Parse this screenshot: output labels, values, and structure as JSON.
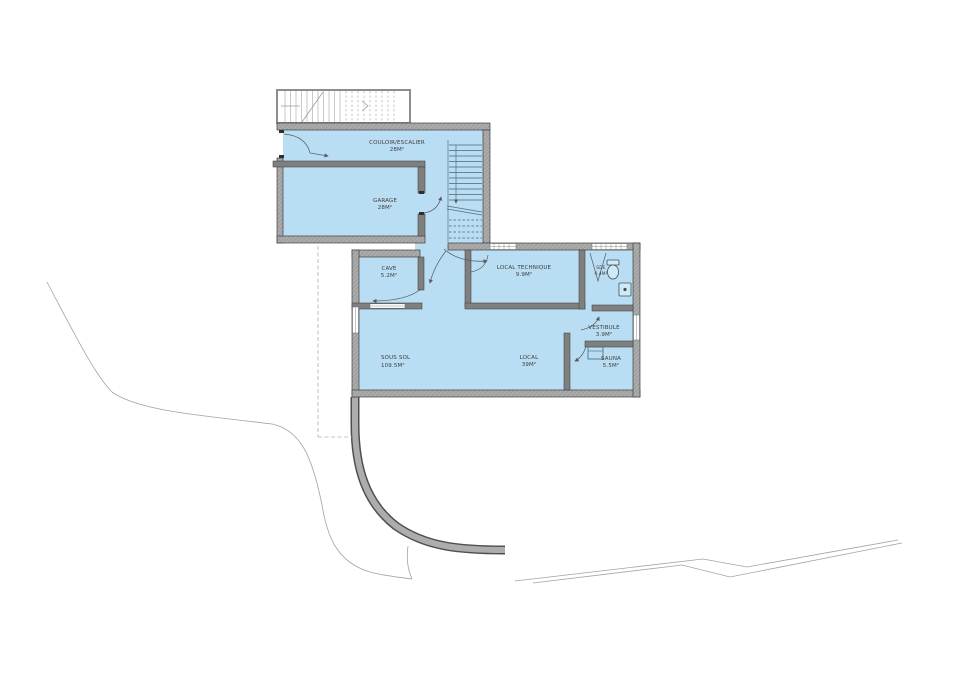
{
  "plan": {
    "rooms": [
      {
        "id": "couloir",
        "name": "COULOIR/ESCALIER",
        "area": "28M²"
      },
      {
        "id": "garage",
        "name": "GARAGE",
        "area": "28M²"
      },
      {
        "id": "cave",
        "name": "CAVE",
        "area": "5.2M²"
      },
      {
        "id": "local-technique",
        "name": "LOCAL TECHNIQUE",
        "area": "9.9M²"
      },
      {
        "id": "sde",
        "name": "SDE",
        "area": "4.4M²"
      },
      {
        "id": "vestibule",
        "name": "VESTIBULE",
        "area": "3.9M²"
      },
      {
        "id": "local",
        "name": "LOCAL",
        "area": "39M²"
      },
      {
        "id": "sauna",
        "name": "SAUNA",
        "area": "5.5M²"
      }
    ],
    "total": {
      "name": "SOUS SOL",
      "area": "109.5M²"
    }
  },
  "colors": {
    "room_fill": "#b9ddf2",
    "outer_wall": "#a8a8a8",
    "inner_wall": "#7f7f7f",
    "wall_edge": "#3f3f3f",
    "door_line": "#5a5a5a",
    "site_line": "#a3a3a3",
    "drive_dark": "#4f4f4f",
    "drive_light": "#adadad",
    "label_text": "#3d3d3d",
    "total_text": "#d4666a"
  }
}
